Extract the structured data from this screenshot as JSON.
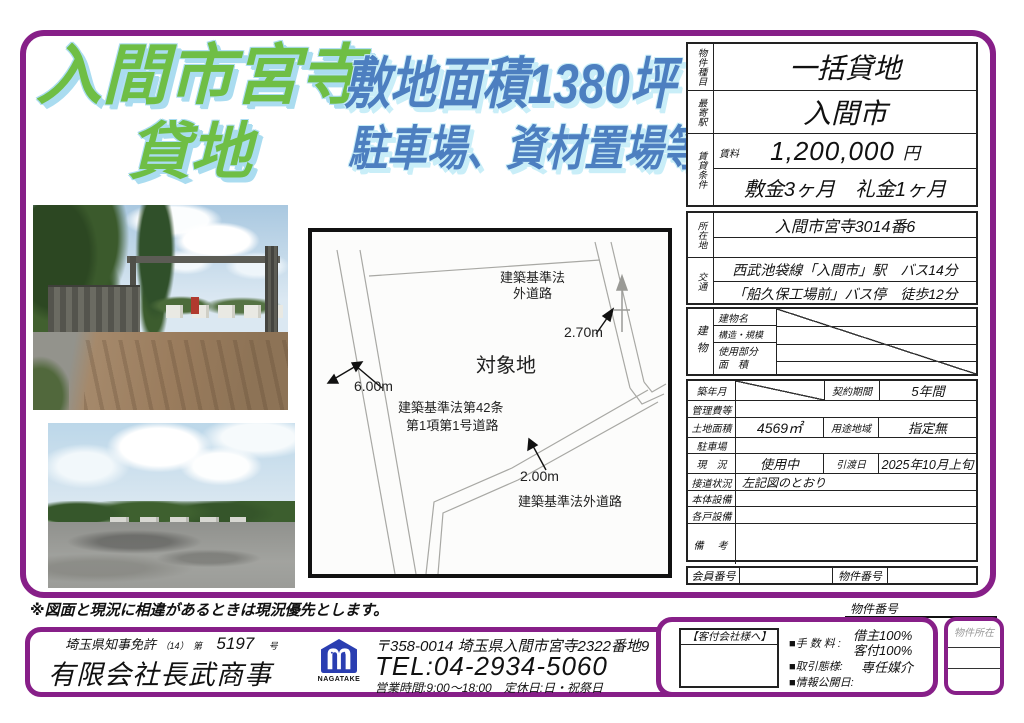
{
  "colors": {
    "frame_purple": "#871f88",
    "title_green": "#6fbe45",
    "title_green_outline": "#aadcf0",
    "title_blue": "#4d7fc0",
    "title_blue_outline": "#c9eef8",
    "logo_blue": "#2a3eb1"
  },
  "titles": {
    "location": "入間市宮寺",
    "type": "貸地",
    "area": "敷地面積1380坪",
    "usage": "駐車場、資材置場等"
  },
  "table": {
    "property_type_label": "物件種目",
    "property_type": "一括貸地",
    "station_label": "最寄駅",
    "station": "入間市",
    "rental_label": "賃貸条件",
    "rent_label": "賃料",
    "rent": "1,200,000",
    "rent_unit": "円",
    "deposit": "敷金3ヶ月　礼金1ヶ月",
    "address_label": "所在地",
    "address": "入間市宮寺3014番6",
    "access_label": "交通",
    "access1": "西武池袋線「入間市」駅　バス14分",
    "access2": "「船久保工場前」バス停　徒歩12分",
    "building_label": "建物",
    "building_name_label": "建物名",
    "structure_label": "構造・規模",
    "used_part_label": "使用部分",
    "used_area_label": "面　積",
    "built_label": "築年月",
    "contract_label": "契約期間",
    "contract": "5年間",
    "mgmt_label": "管理費等",
    "land_area_label": "土地面積",
    "land_area": "4569㎡",
    "zoning_label": "用途地域",
    "zoning": "指定無",
    "parking_label": "駐車場",
    "status_label": "現　況",
    "status": "使用中",
    "handover_label": "引渡日",
    "handover": "2025年10月上旬",
    "road_label": "接道状況",
    "road": "左記図のとおり",
    "main_equip_label": "本体設備",
    "unit_equip_label": "各戸設備",
    "notes_label": "備　考",
    "member_no_label": "会員番号",
    "property_no_label": "物件番号"
  },
  "map": {
    "law_road_top1": "建築基準法",
    "law_road_top2": "外道路",
    "width_right": "2.70m",
    "target_site": "対象地",
    "width_left": "6.00m",
    "road42_line1": "建築基準法第42条",
    "road42_line2": "第1項第1号道路",
    "width_bottom": "2.00m",
    "law_road_bottom": "建築基準法外道路"
  },
  "note": "※図面と現況に相違があるときは現況優先とします。",
  "footer": {
    "license_name": "埼玉県知事免許",
    "license_paren": "（14）",
    "license_dai": "第",
    "license_no": "5197",
    "license_go": "号",
    "company": "有限会社長武商事",
    "logo_text": "NAGATAKE",
    "address": "〒358-0014 埼玉県入間市宮寺2322番地9",
    "tel": "TEL:04-2934-5060",
    "hours": "営業時間:9:00～18:00　定休日:日・祝祭日",
    "property_no_label": "物件番号",
    "to_client_company": "【客付会社様へ】",
    "fee_label": "■手 数 料 :",
    "fee_tenant": "借主100%",
    "fee_client": "客付100%",
    "transaction_label": "■取引態様:",
    "transaction": "専任媒介",
    "release_label": "■情報公開日:",
    "property_location_label": "物件所在"
  }
}
